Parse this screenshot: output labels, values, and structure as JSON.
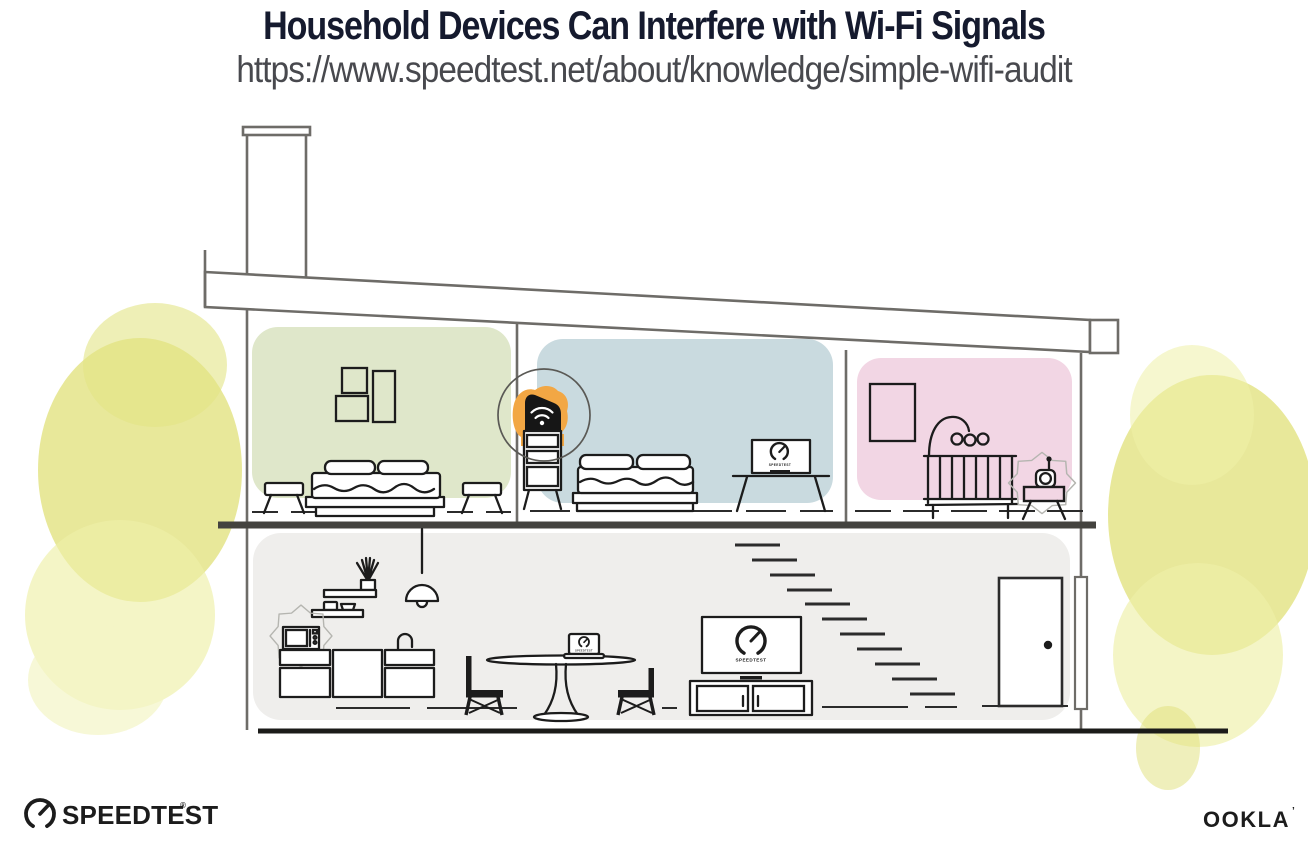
{
  "header": {
    "title": "Household Devices Can Interfere with Wi-Fi Signals",
    "url": "https://www.speedtest.net/about/knowledge/simple-wifi-audit"
  },
  "devices": {
    "screen_brand_label": "SPEEDTEST"
  },
  "footer": {
    "speedtest_wordmark": "SPEEDTEST",
    "speedtest_trademark": "®",
    "ookla_wordmark": "OOKLA",
    "ookla_trademark": "’"
  },
  "icons": {
    "wifi-icon": "wifi arcs on black router",
    "speedtest-gauge-icon": "speedometer dial with needle",
    "registered-mark-icon": "®"
  },
  "colors": {
    "title_navy": "#151a2e",
    "url_gray": "#48494e",
    "room_green": "#dfe7ca",
    "room_blue": "#c9dadf",
    "room_pink": "#f2d6e4",
    "lower_floor_gray": "#efeeec",
    "router_orange": "#f2a744",
    "foliage_yellow": "#e0e078",
    "line_dark": "#1c1c1c",
    "structure_gray": "#6e6c68"
  }
}
